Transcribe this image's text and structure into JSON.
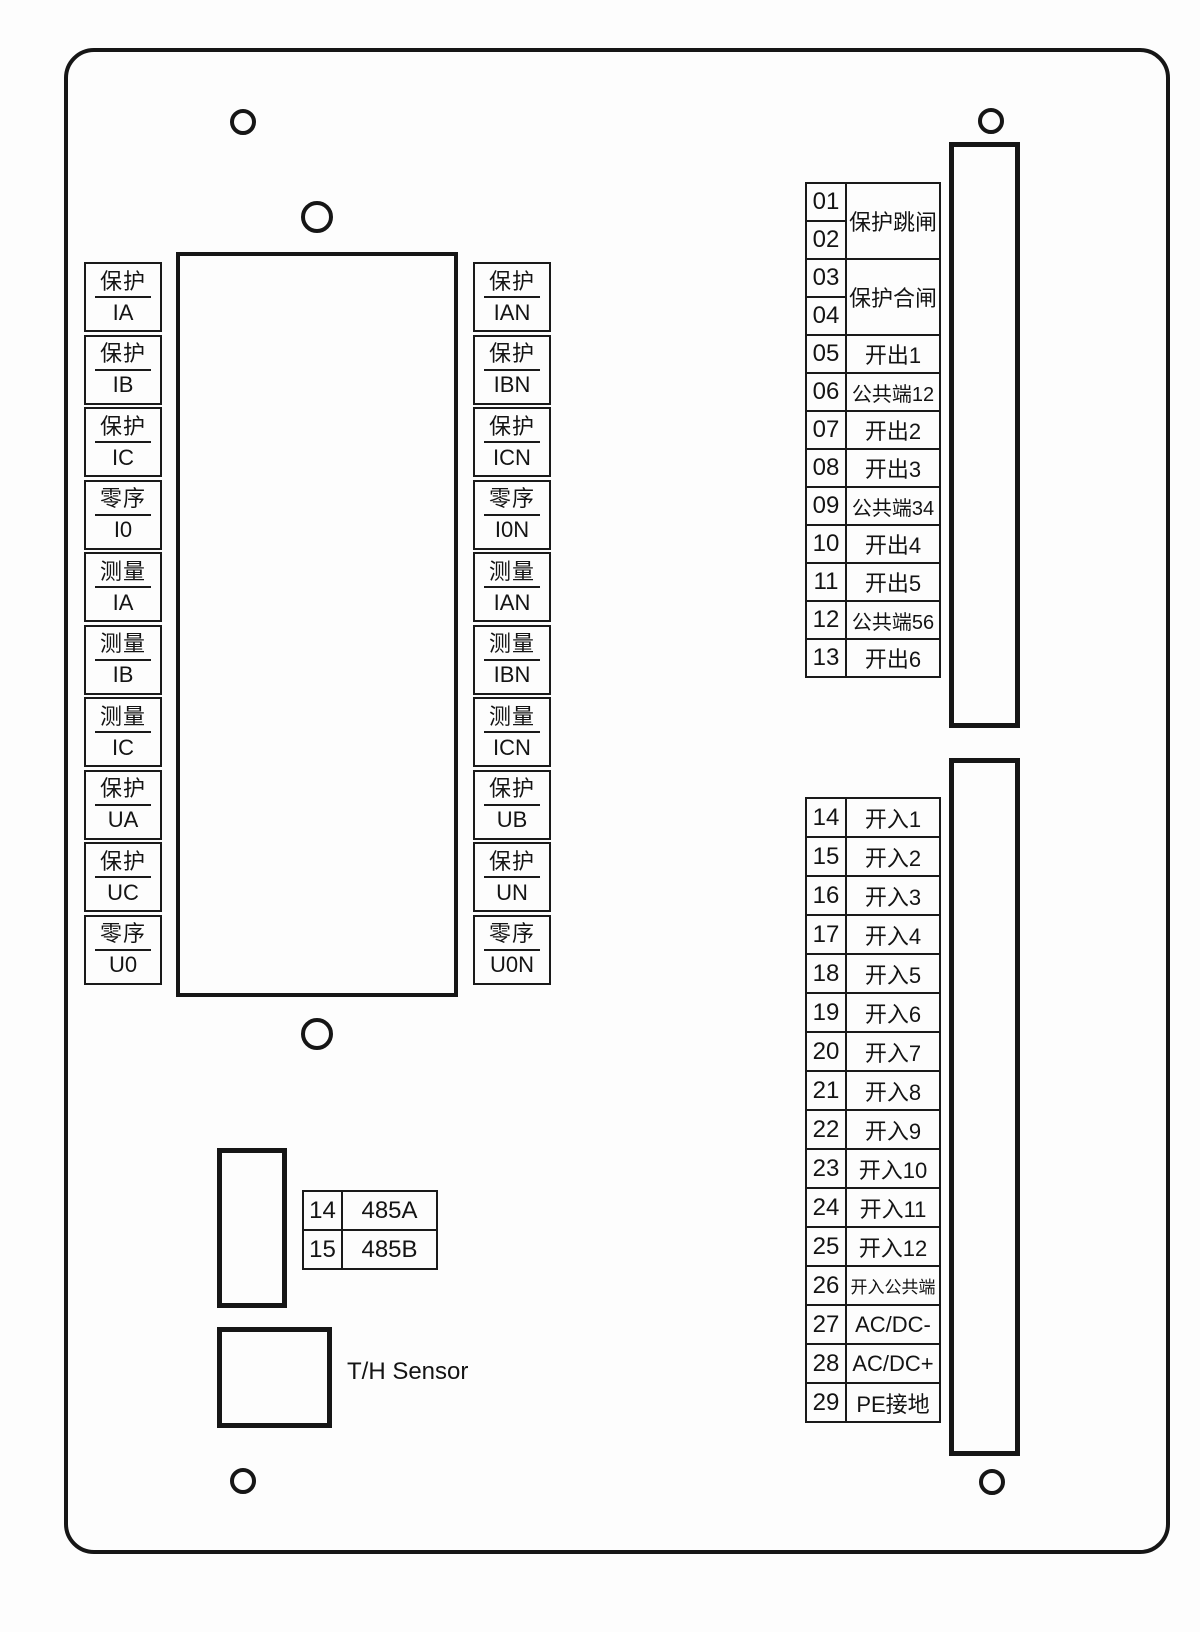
{
  "left_column": [
    {
      "top": "保护",
      "bottom": "IA"
    },
    {
      "top": "保护",
      "bottom": "IB"
    },
    {
      "top": "保护",
      "bottom": "IC"
    },
    {
      "top": "零序",
      "bottom": "I0"
    },
    {
      "top": "测量",
      "bottom": "IA"
    },
    {
      "top": "测量",
      "bottom": "IB"
    },
    {
      "top": "测量",
      "bottom": "IC"
    },
    {
      "top": "保护",
      "bottom": "UA"
    },
    {
      "top": "保护",
      "bottom": "UC"
    },
    {
      "top": "零序",
      "bottom": "U0"
    }
  ],
  "right_column": [
    {
      "top": "保护",
      "bottom": "IAN"
    },
    {
      "top": "保护",
      "bottom": "IBN"
    },
    {
      "top": "保护",
      "bottom": "ICN"
    },
    {
      "top": "零序",
      "bottom": "I0N"
    },
    {
      "top": "测量",
      "bottom": "IAN"
    },
    {
      "top": "测量",
      "bottom": "IBN"
    },
    {
      "top": "测量",
      "bottom": "ICN"
    },
    {
      "top": "保护",
      "bottom": "UB"
    },
    {
      "top": "保护",
      "bottom": "UN"
    },
    {
      "top": "零序",
      "bottom": "U0N"
    }
  ],
  "output_table": {
    "rows": [
      {
        "num": "01",
        "label": "保护跳闸"
      },
      {
        "num": "02"
      },
      {
        "num": "03",
        "label": "保护合闸"
      },
      {
        "num": "04"
      },
      {
        "num": "05",
        "label": "开出1"
      },
      {
        "num": "06",
        "label": "公共端12"
      },
      {
        "num": "07",
        "label": "开出2"
      },
      {
        "num": "08",
        "label": "开出3"
      },
      {
        "num": "09",
        "label": "公共端34"
      },
      {
        "num": "10",
        "label": "开出4"
      },
      {
        "num": "11",
        "label": "开出5"
      },
      {
        "num": "12",
        "label": "公共端56"
      },
      {
        "num": "13",
        "label": "开出6"
      }
    ]
  },
  "input_table": {
    "rows": [
      {
        "num": "14",
        "label": "开入1"
      },
      {
        "num": "15",
        "label": "开入2"
      },
      {
        "num": "16",
        "label": "开入3"
      },
      {
        "num": "17",
        "label": "开入4"
      },
      {
        "num": "18",
        "label": "开入5"
      },
      {
        "num": "19",
        "label": "开入6"
      },
      {
        "num": "20",
        "label": "开入7"
      },
      {
        "num": "21",
        "label": "开入8"
      },
      {
        "num": "22",
        "label": "开入9"
      },
      {
        "num": "23",
        "label": "开入10"
      },
      {
        "num": "24",
        "label": "开入11"
      },
      {
        "num": "25",
        "label": "开入12"
      },
      {
        "num": "26",
        "label": "开入公共端"
      },
      {
        "num": "27",
        "label": "AC/DC-"
      },
      {
        "num": "28",
        "label": "AC/DC+"
      },
      {
        "num": "29",
        "label": "PE接地"
      }
    ]
  },
  "comm_table": {
    "rows": [
      {
        "num": "14",
        "label": "485A"
      },
      {
        "num": "15",
        "label": "485B"
      }
    ]
  },
  "labels": {
    "th_sensor": "T/H Sensor"
  },
  "colors": {
    "stroke": "#161616",
    "background": "#fdfdfd"
  }
}
